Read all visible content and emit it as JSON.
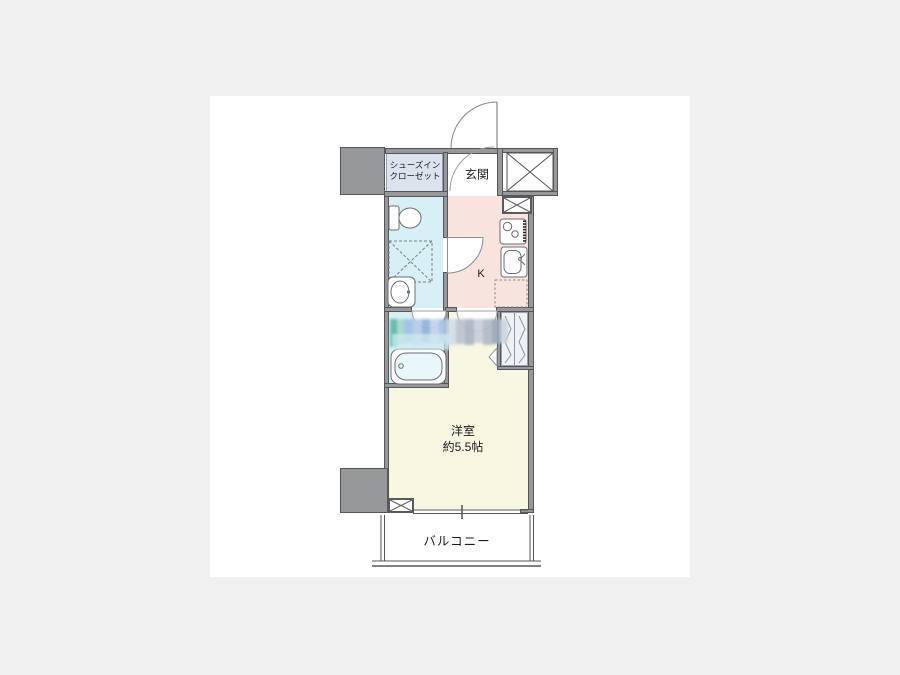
{
  "page": {
    "background_color": "#f0f0f0",
    "card_color": "#ffffff"
  },
  "floorplan": {
    "wall_color": "#97989a",
    "rooms": {
      "shoe_closet": {
        "line1": "シューズイン",
        "line2": "クローゼット",
        "color": "#dce3ee"
      },
      "entrance": {
        "label": "玄関",
        "color": "#ffffff"
      },
      "kitchen": {
        "label": "K",
        "color": "#f9e3de"
      },
      "toilet_laundry": {
        "color": "#d6f0f6"
      },
      "bathroom": {
        "color": "#d6f0f6"
      },
      "western_room": {
        "name": "洋室",
        "size": "約5.5帖",
        "color": "#f8f7e2"
      },
      "balcony": {
        "label": "バルコニー",
        "color": "#ffffff"
      }
    },
    "icons": [
      "entrance-door-icon",
      "genkan-door-arc",
      "kitchen-door-icon",
      "bathroom-door-icon",
      "hall-door-icon",
      "elevator-shaft-icon",
      "pipe-space-icon",
      "pipe-space-bottom-icon",
      "toilet-icon",
      "washing-machine-space-icon",
      "washbasin-icon",
      "gas-stove-icon",
      "kitchen-sink-icon",
      "refrigerator-space-icon",
      "bathtub-icon",
      "closet-folding-door-icon",
      "window-icon",
      "balcony-railing-icon",
      "watermark"
    ]
  }
}
